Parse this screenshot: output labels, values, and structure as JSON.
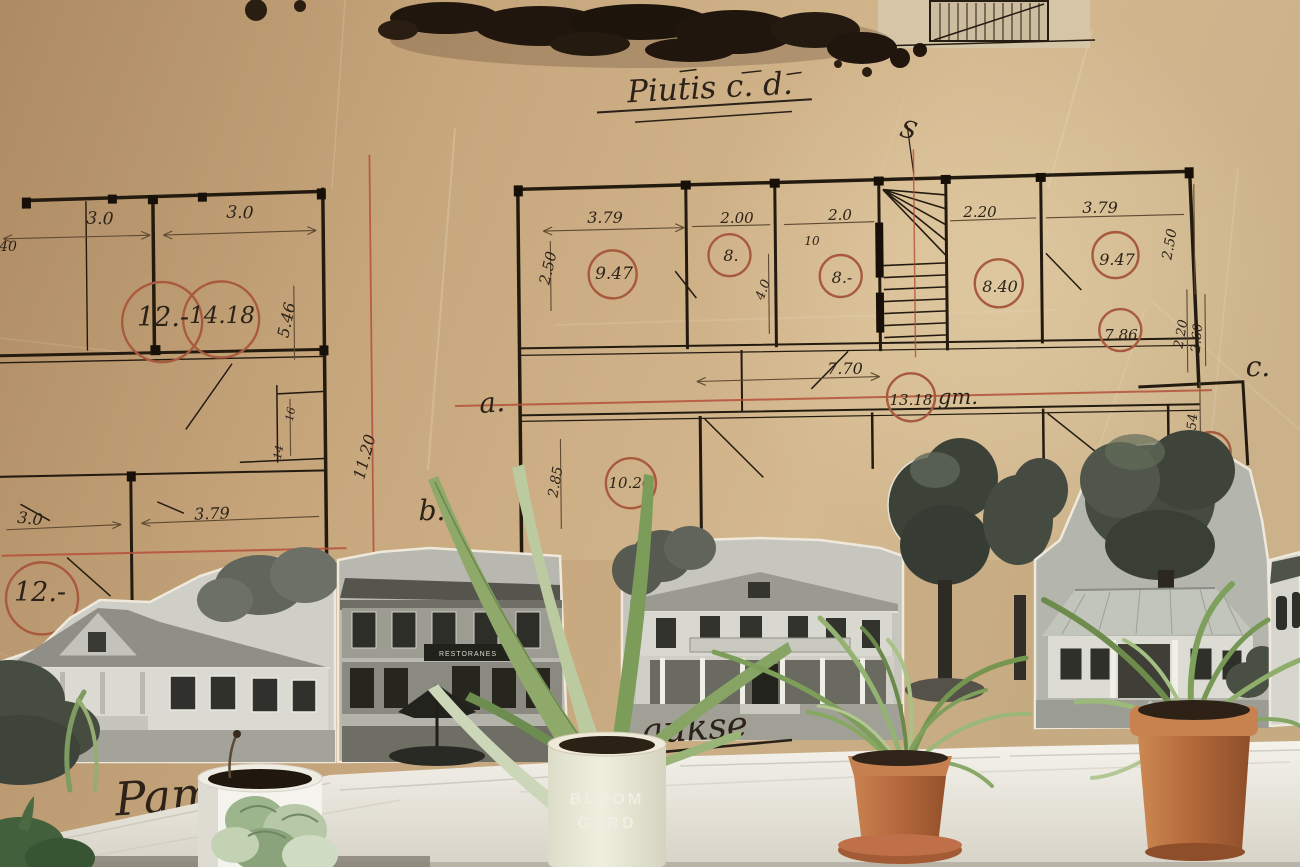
{
  "plan": {
    "title": "Piutis c. d.",
    "stair_mark": "S",
    "letters": {
      "a": "a.",
      "b": "b.",
      "c": "c."
    },
    "left_building": {
      "rooms": {
        "room_12_top": "12.-",
        "room_1418": "14.18",
        "room_12_bottom": "12.-"
      },
      "dims": {
        "top_w1": "3.0",
        "top_w2": "3.0",
        "edge_40": "40",
        "h_546": "5.46",
        "small_16": "16",
        "small_14": "14",
        "v_1120": "11.20",
        "bottom_w1": "3.0",
        "bottom_w2": "3.79"
      }
    },
    "right_building": {
      "rooms": {
        "room_947_left": "9.47",
        "room_8_first": "8.",
        "room_8_second": "8.-",
        "room_840": "8.40",
        "room_947_right": "9.47",
        "room_786": "7.86",
        "room_1318": "13.18",
        "room_1318_suffix": "gm.",
        "room_1026": "10.26",
        "room_10_partial": "10."
      },
      "dims": {
        "w_379_left": "3.79",
        "v_250_left": "2.50",
        "w_200": "2.00",
        "small_10": "10",
        "w_20": "2.0",
        "v_40": "4.0",
        "w_220": "2.20",
        "w_379_right": "3.79",
        "v_250_right": "2.50",
        "v_220_right": "2.20",
        "w_770": "7.70",
        "v_285": "2.85",
        "v_260": "2.60",
        "v_254": "2.54"
      }
    },
    "scripts": {
      "bottom_left": "Pam",
      "bottom_center": "aukse"
    }
  },
  "photos": {
    "restaurant_sign": "RESTORANES"
  },
  "plants": {
    "pot_label_line1": "BLOOM",
    "pot_label_line2": "GARD"
  }
}
